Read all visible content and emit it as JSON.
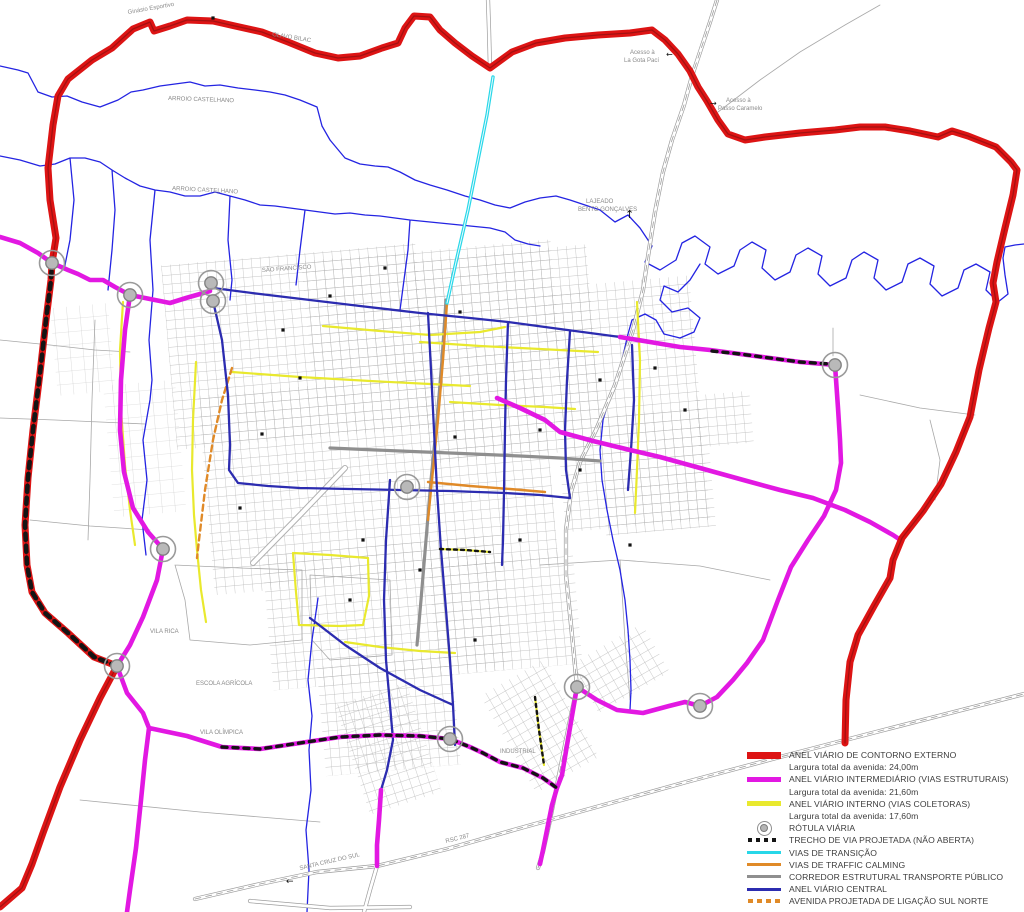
{
  "colors": {
    "red": "#dd1414",
    "red_core": "#a31111",
    "magenta": "#e218e2",
    "yellow": "#e9e92e",
    "blue_ring": "#2c2cb0",
    "river": "#2424e2",
    "cyan": "#28d7e8",
    "orange": "#e08a28",
    "corridor_gray": "#8f8f8f",
    "road_gray": "#9d9d9d",
    "projected_black": "#141414"
  },
  "legend": {
    "items": [
      {
        "symbol": "bar-red",
        "label": "ANEL VIÁRIO DE CONTORNO EXTERNO"
      },
      {
        "symbol": "none",
        "label": "Largura total da avenida: 24,00m"
      },
      {
        "symbol": "bar-magenta",
        "label": "ANEL VIÁRIO INTERMEDIÁRIO (VIAS ESTRUTURAIS)"
      },
      {
        "symbol": "none",
        "label": "Largura total da avenida: 21,60m"
      },
      {
        "symbol": "bar-yellow",
        "label": "ANEL VIÁRIO INTERNO (VIAS COLETORAS)"
      },
      {
        "symbol": "none",
        "label": "Largura total da avenida: 17,60m"
      },
      {
        "symbol": "rotula",
        "label": "RÓTULA VIÁRIA"
      },
      {
        "symbol": "dash-black",
        "label": "TRECHO DE VIA PROJETADA (NÃO ABERTA)"
      },
      {
        "symbol": "bar-cyan",
        "label": "VIAS DE TRANSIÇÃO"
      },
      {
        "symbol": "bar-orange",
        "label": "VIAS DE TRAFFIC CALMING"
      },
      {
        "symbol": "bar-gray",
        "label": "CORREDOR ESTRUTURAL TRANSPORTE PÚBLICO"
      },
      {
        "symbol": "bar-blue",
        "label": "ANEL VIÁRIO CENTRAL"
      },
      {
        "symbol": "dash-orange",
        "label": "AVENIDA PROJETADA DE LIGAÇÃO SUL NORTE"
      }
    ]
  },
  "map": {
    "labels": [
      {
        "text": "Ginásio Esportivo",
        "x": 128,
        "y": 14,
        "r": -10
      },
      {
        "text": "OLAVO BILAC",
        "x": 272,
        "y": 36,
        "r": 9
      },
      {
        "text": "ARROIO CASTELHANO",
        "x": 168,
        "y": 100,
        "r": 2
      },
      {
        "text": "ARROIO CASTELHANO",
        "x": 172,
        "y": 190,
        "r": 3
      },
      {
        "text": "SÃO FRANCISCO",
        "x": 262,
        "y": 272,
        "r": -4
      },
      {
        "text": "Acesso à",
        "x": 630,
        "y": 54,
        "r": 0
      },
      {
        "text": "La Gota Pací",
        "x": 624,
        "y": 62,
        "r": 0
      },
      {
        "text": "Acesso à",
        "x": 726,
        "y": 102,
        "r": 0
      },
      {
        "text": "Passo Caramelo",
        "x": 718,
        "y": 110,
        "r": 0
      },
      {
        "text": "LAJEADO",
        "x": 586,
        "y": 203,
        "r": 0
      },
      {
        "text": "BENTO GONÇALVES",
        "x": 578,
        "y": 211,
        "r": 0
      },
      {
        "text": "VILA RICA",
        "x": 150,
        "y": 633,
        "r": 0
      },
      {
        "text": "ESCOLA AGRÍCOLA",
        "x": 196,
        "y": 685,
        "r": 0
      },
      {
        "text": "VILA OLÍMPICA",
        "x": 200,
        "y": 734,
        "r": 0
      },
      {
        "text": "INDUSTRIAL",
        "x": 500,
        "y": 753,
        "r": 0
      },
      {
        "text": "SANTA CRUZ DO SUL",
        "x": 300,
        "y": 870,
        "r": -13
      },
      {
        "text": "RSC 287",
        "x": 446,
        "y": 843,
        "r": -14
      }
    ],
    "arrows": [
      {
        "glyph": "↑",
        "x": 625,
        "y": 218,
        "s": 11
      },
      {
        "glyph": "←",
        "x": 286,
        "y": 884,
        "s": 9
      },
      {
        "glyph": "←",
        "x": 666,
        "y": 57,
        "s": 8
      },
      {
        "glyph": "→",
        "x": 710,
        "y": 106,
        "s": 8
      }
    ],
    "roundabouts": [
      [
        52,
        263
      ],
      [
        130,
        295
      ],
      [
        211,
        283
      ],
      [
        213,
        301
      ],
      [
        163,
        549
      ],
      [
        117,
        666
      ],
      [
        407,
        487
      ],
      [
        450,
        739
      ],
      [
        577,
        687
      ],
      [
        700,
        706
      ],
      [
        835,
        365
      ]
    ],
    "buildings": [
      [
        213,
        18
      ],
      [
        330,
        296
      ],
      [
        385,
        268
      ],
      [
        460,
        312
      ],
      [
        300,
        378
      ],
      [
        262,
        434
      ],
      [
        455,
        437
      ],
      [
        540,
        430
      ],
      [
        600,
        380
      ],
      [
        655,
        368
      ],
      [
        580,
        470
      ],
      [
        520,
        540
      ],
      [
        420,
        570
      ],
      [
        350,
        600
      ],
      [
        630,
        545
      ],
      [
        685,
        410
      ],
      [
        240,
        508
      ],
      [
        475,
        640
      ],
      [
        363,
        540
      ],
      [
        283,
        330
      ]
    ],
    "grid_groups": [
      {
        "rot": [
          -5,
          440,
          470
        ],
        "pattern": "gridA",
        "rects": [
          [
            180,
            242,
            255,
            185
          ],
          [
            320,
            250,
            250,
            125
          ],
          [
            430,
            258,
            175,
            205
          ],
          [
            560,
            298,
            145,
            245
          ],
          [
            205,
            375,
            345,
            200
          ],
          [
            420,
            560,
            145,
            115
          ],
          [
            255,
            540,
            240,
            135
          ],
          [
            300,
            655,
            135,
            110
          ],
          [
            600,
            430,
            110,
            120
          ],
          [
            700,
            418,
            55,
            52
          ]
        ]
      },
      {
        "rot": [
          -18,
          390,
          740
        ],
        "pattern": "gridA",
        "rects": [
          [
            348,
            690,
            75,
            115
          ]
        ]
      },
      {
        "rot": [
          -30,
          560,
          710
        ],
        "pattern": "gridA",
        "rects": [
          [
            498,
            658,
            72,
            112
          ],
          [
            592,
            676,
            82,
            56
          ]
        ]
      },
      {
        "rot": [
          -5,
          150,
          440
        ],
        "pattern": "gridB",
        "rects": [
          [
            108,
            382,
            72,
            132
          ],
          [
            62,
            300,
            58,
            88
          ]
        ]
      }
    ],
    "layers": [
      {
        "name": "rural-roads",
        "stroke": "#a8a8a8",
        "w": 0.8,
        "d": "M0,340 L50,345 95,350 130,352 M0,418 L55,420 100,422 145,424 M30,520 L90,526 150,530 M95,320 L92,400 90,480 88,540 M860,395 L920,408 975,415 M930,420 L940,460 935,500 M833,328 L833,356 M540,565 L620,560 700,566 770,580 M620,560 L625,640 630,700 M175,565 L240,568 302,570 302,640 250,645 190,640 185,600 175,565 M310,575 L390,580 392,655 330,660 312,640 310,575 M80,800 L200,812 320,822 M718,112 L760,80 800,52 845,25 880,5"
      },
      {
        "name": "rivers",
        "stroke": "#2424e2",
        "w": 1.3,
        "d": "M0,66 L18,70 28,73 38,92 52,97 67,96 82,102 100,107 118,100 131,92 143,90 160,86 175,84 190,82 205,86 220,85 238,88 255,90 270,92 285,95 300,100 317,107 322,126 330,140 345,158 360,164 375,166 388,167 400,172 415,180 430,185 447,190 465,196 480,200 495,205 510,208 525,202 540,198 556,196 570,200 585,205 600,210 615,222 628,215 640,228 M640,228 L652,246 645,262 660,270 676,260 682,243 695,236 710,247 705,264 718,274 734,266 740,250 752,242 766,250 762,268 775,280 790,272 796,255 808,248 822,256 818,274 830,286 846,278 852,260 864,252 878,260 874,278 886,290 902,282 908,264 920,258 934,266 930,284 942,296 958,288 964,270 976,264 990,272 986,290 998,302 1008,294 1005,275 1003,258 1005,247 1015,245 1024,244 M700,264 L690,280 678,292 664,286 660,300 672,312 688,308 700,318 694,332 680,338 664,334 656,320 645,314 632,320 628,334 M0,156 L20,160 40,166 55,164 70,158 85,158 100,162 112,170 125,178 140,186 155,190 170,192 185,196 200,196 215,192 230,196 245,200 260,205 275,206 290,208 305,210 320,212 335,214 350,213 365,215 380,216 395,218 410,220 430,222 450,224 470,226 490,228 505,232 515,240 528,244 540,246 M112,170 L115,210 112,250 108,290 M230,196 L228,240 232,280 230,300 M305,210 L300,250 296,285 M410,220 L408,250 404,280 400,310 M155,190 L150,240 153,290 149,340 152,380 150,400 143,440 147,480 142,520 146,555 M628,334 L622,360 612,390 603,420 600,450 602,480 607,510 613,540 620,570 625,600 628,630 630,660 631,690 630,710 M318,598 L312,640 308,680 312,716 309,750 311,790 306,830 309,870 307,912 M70,158 L74,200 70,240 64,270"
      },
      {
        "name": "highway-casing",
        "stroke": "#9d9d9d",
        "w": 4.2,
        "d": "M717,0 L710,22 700,52 692,76 684,105 672,140 663,172 655,212 649,250 643,290 633,330 615,385 596,430 580,462 571,492 566,530 566,575 571,625 577,687 L570,720 563,755 556,790 549,825 543,852 538,868 M195,899 L260,884 317,872 377,866 447,849 517,829 600,806 690,781 780,757 880,731 1024,694 M377,866 L370,890 364,912 M250,901 L330,908 410,907 M490,68 L489,30 488,0"
      },
      {
        "name": "highway-fill",
        "stroke": "#ffffff",
        "w": 2.8,
        "d": "M717,0 L710,22 700,52 692,76 684,105 672,140 663,172 655,212 649,250 643,290 633,330 615,385 596,430 580,462 571,492 566,530 566,575 571,625 577,687 L570,720 563,755 556,790 549,825 543,852 538,868 M195,899 L260,884 317,872 377,866 447,849 517,829 600,806 690,781 780,757 880,731 1024,694 M377,866 L370,890 364,912 M250,901 L330,908 410,907 M490,68 L489,30 488,0"
      },
      {
        "name": "highway-centerline",
        "stroke": "#9d9d9d",
        "w": 0.8,
        "dash": "6 5",
        "d": "M717,0 L710,22 700,52 692,76 684,105 672,140 663,172 655,212 649,250 643,290 633,330 615,385 596,430 580,462 571,492 566,530 566,575 571,625 577,687 L570,720 563,755 556,790 549,825 543,852 538,868 M195,899 L260,884 317,872 377,866 447,849 517,829 600,806 690,781 780,757 880,731 1024,694"
      },
      {
        "name": "diagonal-avenue-casing",
        "stroke": "#b0b0b0",
        "w": 6,
        "d": "M253,563 L300,515 345,468"
      },
      {
        "name": "diagonal-avenue-fill",
        "stroke": "#ffffff",
        "w": 4,
        "d": "M253,563 L300,515 345,468"
      },
      {
        "name": "transit-corridor",
        "stroke": "#8f8f8f",
        "w": 3.2,
        "d": "M446,300 L442,360 437,420 431,480 426,540 421,600 417,645 M330,448 L400,451 450,453 520,456 560,458 600,461"
      },
      {
        "name": "inner-ring-yellow",
        "stroke": "#e9e92e",
        "w": 2.2,
        "d": "M123,302 L120,350 121,410 125,465 130,510 135,545 M196,362 L193,420 192,470 194,515 197,550 201,590 206,622 M323,326 L380,331 430,335 480,332 505,327 M420,342 L480,346 540,349 598,352 M232,372 L300,377 370,381 430,384 470,386 M450,402 L500,405 545,407 575,409 M637,302 L640,360 639,420 637,470 635,513 M293,553 L296,592 299,625 340,626 363,625 369,596 368,558 330,555 293,553 M440,549 L465,550 490,552 M535,697 L539,730 544,765 M345,642 L380,647 420,651 455,653"
      },
      {
        "name": "traffic-calming-orange",
        "stroke": "#e08a28",
        "w": 2.4,
        "d": "M447,303 L443,360 438,420 432,480 428,520 M428,482 L470,486 510,489 545,492"
      },
      {
        "name": "projected-avenue-orange-dash",
        "stroke": "#e08a28",
        "w": 2.4,
        "dash": "6 4",
        "d": "M232,368 L222,400 213,440 205,490 199,540 197,558"
      },
      {
        "name": "central-ring-blue",
        "stroke": "#2c2cb0",
        "w": 2.3,
        "d": "M213,288 L260,294 310,300 360,306 420,313 470,318 508,322 545,327 575,331 620,337 M213,301 L222,340 228,395 230,445 229,470 238,483 268,486 300,488 L350,489 400,490 450,491 505,493 540,495 570,498 M428,313 L431,370 434,430 437,490 441,550 446,610 450,660 453,705 455,745 M508,322 L506,380 505,430 504,492 503,540 502,565 M570,331 L567,380 565,430 566,470 570,498 M310,618 L345,645 380,668 420,690 453,705 M390,480 L386,540 384,600 386,660 390,705 393,740 387,770 381,790 M632,345 L634,400 631,450 628,490"
      },
      {
        "name": "transition-cyan",
        "stroke": "#28d7e8",
        "w": 3.4,
        "d": "M493,77 L487,115 478,160 468,210 456,262 447,303"
      },
      {
        "name": "transition-cyan-core",
        "stroke": "#eafcff",
        "w": 1,
        "d": "M493,77 L487,115 478,160 468,210 456,262 447,303"
      },
      {
        "name": "intermediate-ring-magenta",
        "stroke": "#e218e2",
        "w": 4.6,
        "d": "M0,237 L20,243 38,253 52,263 L68,270 78,274 90,280 103,280 115,287 130,295 L150,299 170,303 186,298 200,294 210,291 M130,295 L125,330 121,380 120,430 124,472 133,508 148,532 163,549 L157,580 143,617 130,645 117,666 L127,693 143,713 149,728 L187,736 222,747 L260,749 300,743 340,737 380,735 420,736 450,739 L470,747 483,753 500,762 523,768 543,778 557,788 M149,728 L145,760 141,800 136,848 130,890 127,912 M577,687 L572,716 567,745 562,775 557,788 L552,805 547,830 543,850 540,864 M577,687 L597,700 617,710 643,713 669,706 685,702 700,706 L717,697 733,680 747,663 763,640 778,600 791,567 808,540 824,516 836,490 841,463 840,440 838,408 835,365 M620,337 L650,342 680,347 710,350 740,354 770,358 800,362 835,365 M497,398 L520,408 545,420 560,432 593,441 630,450 660,457 700,468 747,481 780,490 813,498 845,510 870,522 893,535 902,541 M381,790 L379,820 377,845 377,866"
      },
      {
        "name": "outer-ring-red",
        "stroke": "#dd1414",
        "w": 7,
        "d": "M0,907 L22,888 32,864 43,833 60,787 80,740 100,698 117,666 L94,657 68,633 45,613 32,592 27,565 25,525 28,478 33,430 40,373 46,320 51,280 52,263 L56,238 50,200 48,168 53,125 58,96 68,79 92,60 112,48 133,29 150,22 154,31 170,26 187,20 213,21 235,26 262,32 288,42 315,53 338,58 360,56 382,48 398,43 405,28 414,16 430,17 440,30 455,43 472,56 490,68 512,52 536,43 565,38 598,35 630,33 652,30 665,40 678,54 690,71 698,87 707,101 718,120 728,134 745,140 765,137 800,133 835,130 860,127 885,127 910,131 938,137 952,131 968,136 996,147 1011,162 1017,170 1013,195 1005,228 997,262 993,283 996,302 989,328 979,370 970,417 956,452 941,484 923,511 902,538 893,560 890,578 874,606 858,635 850,662 846,700 845,743"
      },
      {
        "name": "outer-ring-red-core",
        "stroke": "#a31111",
        "w": 1.3,
        "d": "M0,907 L22,888 32,864 43,833 60,787 80,740 100,698 117,666 L94,657 68,633 45,613 32,592 27,565 25,525 28,478 33,430 40,373 46,320 51,280 52,263 L56,238 50,200 48,168 53,125 58,96 68,79 92,60 112,48 133,29 150,22 154,31 170,26 187,20 213,21 235,26 262,32 288,42 315,53 338,58 360,56 382,48 398,43 405,28 414,16 430,17 440,30 455,43 472,56 490,68 512,52 536,43 565,38 598,35 630,33 652,30 665,40 678,54 690,71 698,87 707,101 718,120 728,134 745,140 765,137 800,133 835,130 860,127 885,127 910,131 938,137 952,131 968,136 996,147 1011,162 1017,170 1013,195 1005,228 997,262 993,283 996,302 989,328 979,370 970,417 956,452 941,484 923,511 902,538 893,560 890,578 874,606 858,635 850,662 846,700 845,743"
      },
      {
        "name": "projected-red-section-dashes",
        "stroke": "#141414",
        "w": 4.6,
        "dash": "6 6",
        "d": "M117,666 L94,657 68,633 45,613 32,592 27,565 25,525 28,478 33,430 40,373 46,320 51,280 52,263"
      },
      {
        "name": "projected-magenta-section-dashes",
        "stroke": "#141414",
        "w": 3.4,
        "dash": "5 6",
        "d": "M222,747 L260,749 300,743 340,737 380,735 420,736 450,739 L470,747 483,753 500,762 523,768 543,778 557,788 M712,351 L740,354 770,358 800,362 830,364"
      },
      {
        "name": "projected-yellow-section-dashes",
        "stroke": "#141414",
        "w": 2.4,
        "dash": "3 4",
        "d": "M440,549 L465,550 490,552 M535,697 L539,730 544,765"
      }
    ]
  }
}
